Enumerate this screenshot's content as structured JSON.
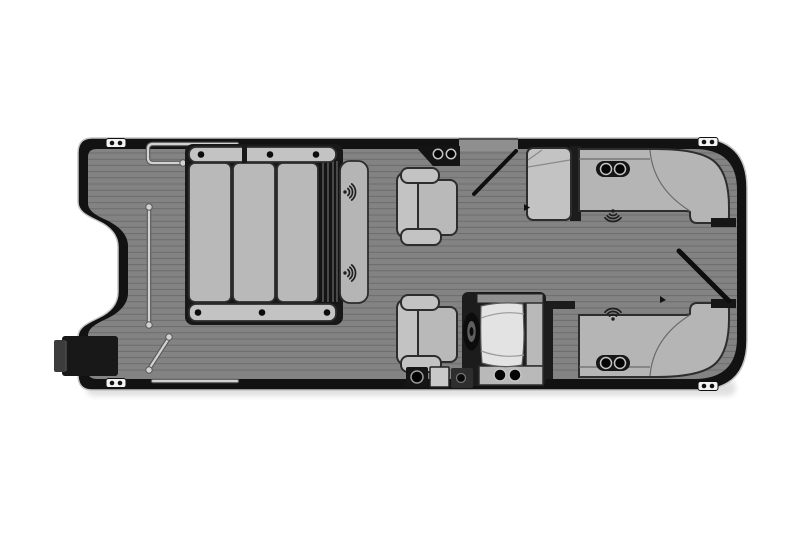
{
  "diagram": {
    "type": "pontoon-boat-floorplan",
    "orientation": "bow-left-stern-right"
  },
  "palette": {
    "background": "#ffffff",
    "hull": "#121212",
    "hull_edge": "#c6c6c6",
    "deck": "#838383",
    "plank": "rgba(0,0,0,0.17)",
    "cushion": "#b9b9b9",
    "cushion_light": "#c3c3c3",
    "bench": "#b5b5b5",
    "white_panel": "#e3e3e3",
    "dark_panel": "#181818",
    "outline": "#2d2d2d",
    "seam": "#6a6a6a",
    "rail": "#d2d2d2",
    "rail_edge": "#5a5a5a",
    "cleat": "#f3f3f3",
    "icon": "#1f1f1f",
    "gate": "#0e0e0e",
    "gap_fill": "#8f8f8f",
    "stripe": "#4f4f4f",
    "wheel": "#0c0c0c",
    "wheel_inner": "#5f5f5f",
    "cap_gray": "#909090"
  },
  "deck": {
    "planks": {
      "from": 153,
      "to": 376,
      "spacing": 6.2,
      "x1": 80,
      "x2": 745
    }
  },
  "cleats": [
    {
      "x": 116,
      "y": 143
    },
    {
      "x": 708,
      "y": 142
    },
    {
      "x": 116,
      "y": 383
    },
    {
      "x": 708,
      "y": 386
    }
  ],
  "cup_holder_pairs": [
    {
      "x1": 438,
      "x2": 451,
      "y": 154,
      "r": 4.7,
      "label": "bow-gate-cupholders"
    },
    {
      "x1": 606,
      "x2": 620,
      "y": 169,
      "r": 5.5,
      "label": "starboard-stern-bench-cupholders"
    },
    {
      "x1": 606,
      "x2": 620,
      "y": 363,
      "r": 5.5,
      "label": "port-stern-bench-cupholders"
    },
    {
      "x1": 500,
      "x2": 515,
      "y": 375,
      "r": 6,
      "label": "helm-console-cupholders"
    }
  ],
  "speakers": [
    {
      "x": 345,
      "y": 192,
      "dir": "right",
      "label": "lounger-backrest-speaker-top"
    },
    {
      "x": 345,
      "y": 273,
      "dir": "right",
      "label": "lounger-backrest-speaker-bottom"
    },
    {
      "x": 613,
      "y": 211,
      "dir": "down",
      "label": "starboard-stern-speaker"
    },
    {
      "x": 613,
      "y": 319,
      "dir": "up",
      "label": "port-stern-speaker"
    }
  ],
  "rails": [
    {
      "d": "M 237,144 L 153,144 Q 148,144 148,149 L 148,158 Q 148,163 153,163 L 181,163",
      "balls": [
        [
          183,
          163
        ]
      ],
      "label": "bow-gate-rail"
    },
    {
      "d": "M 149,208 L 149,324",
      "balls": [
        [
          149,
          207
        ],
        [
          149,
          325
        ]
      ],
      "label": "port-bow-rail"
    },
    {
      "d": "M 149,369 L 169,338",
      "balls": [
        [
          149,
          370
        ],
        [
          169,
          337
        ]
      ],
      "label": "bow-corner-rail"
    },
    {
      "d": "M 153,381 L 237,381",
      "balls": [],
      "label": "port-side-rail"
    }
  ]
}
